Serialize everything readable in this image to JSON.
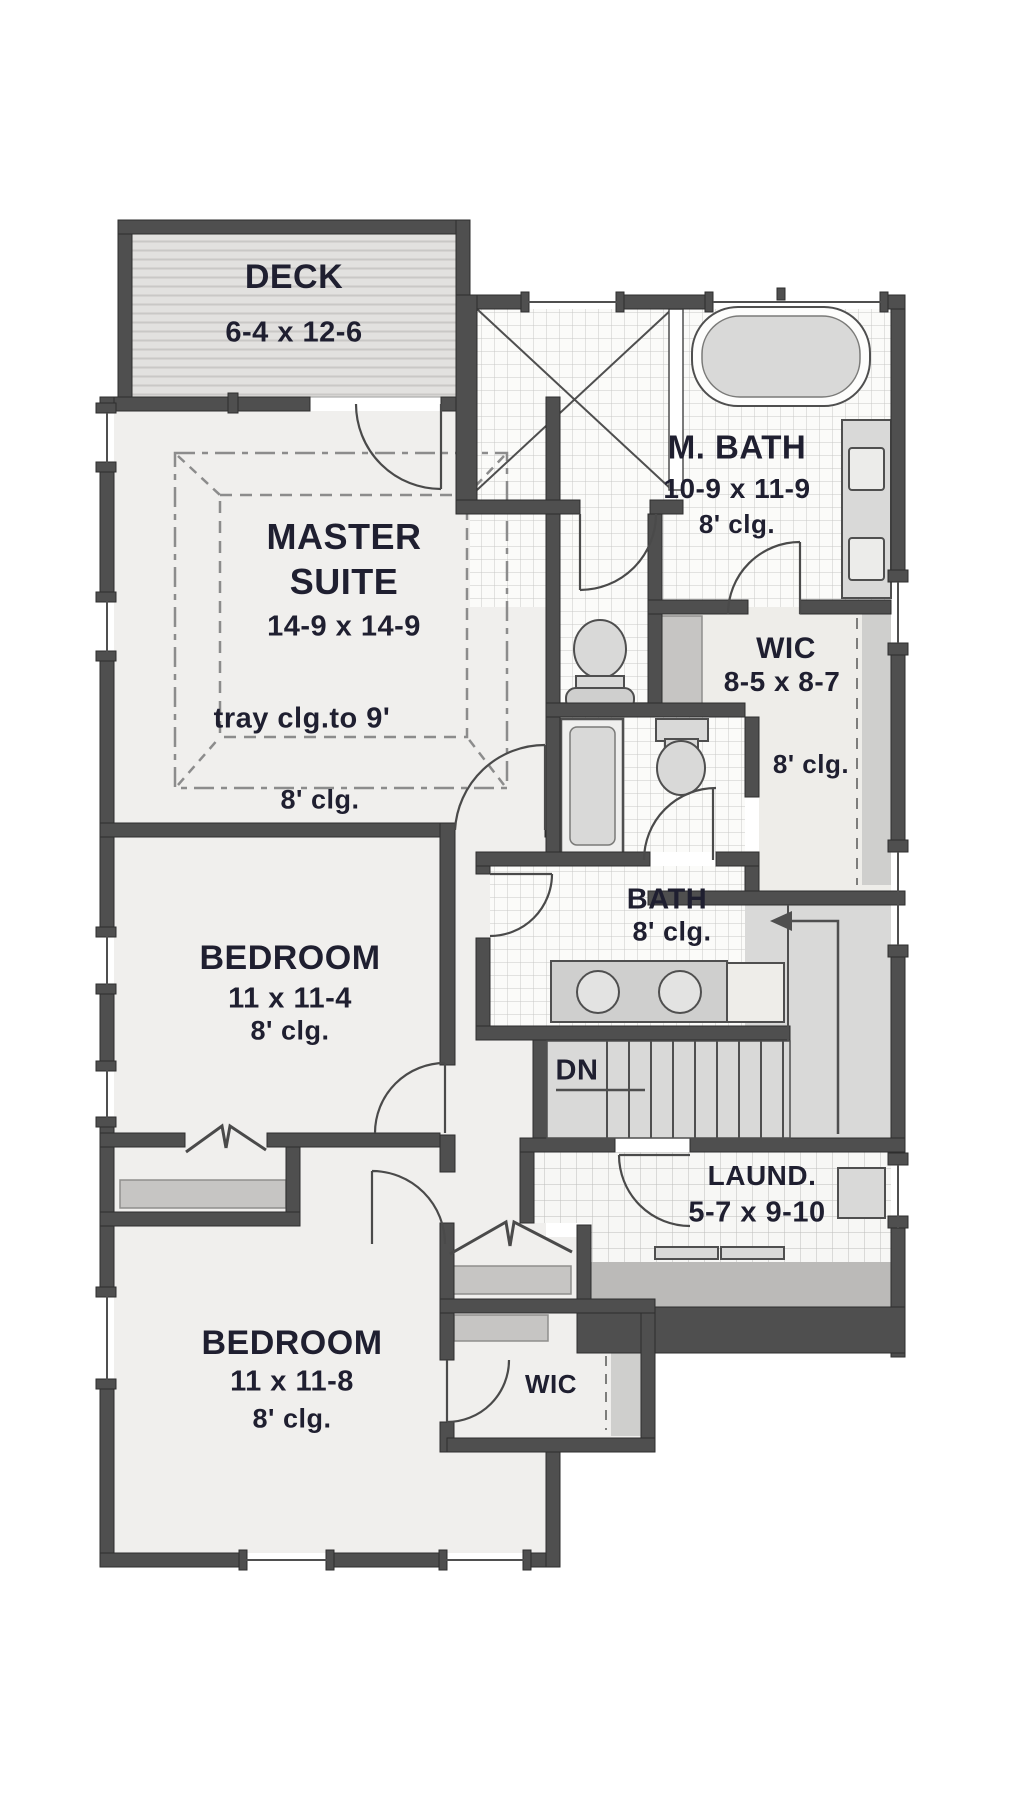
{
  "drawing_type": "floor-plan",
  "rooms": {
    "deck": {
      "name": "DECK",
      "dims": "6-4 x 12-6"
    },
    "master": {
      "name1": "MASTER",
      "name2": "SUITE",
      "dims": "14-9 x 14-9",
      "tray_note": "tray clg.to 9'",
      "clg": "8' clg."
    },
    "master_bath": {
      "name": "M. BATH",
      "dims": "10-9 x 11-9",
      "clg": "8' clg."
    },
    "wic": {
      "name": "WIC",
      "dims": "8-5 x 8-7",
      "clg": "8' clg."
    },
    "bath": {
      "name": "BATH",
      "clg": "8' clg."
    },
    "bedroom1": {
      "name": "BEDROOM",
      "dims": "11 x 11-4",
      "clg": "8' clg."
    },
    "bedroom2": {
      "name": "BEDROOM",
      "dims": "11 x 11-8",
      "clg": "8' clg."
    },
    "laundry": {
      "name": "LAUND.",
      "dims": "5-7 x 9-10"
    },
    "wic2": {
      "name": "WIC"
    },
    "stairs": {
      "direction": "DN"
    }
  },
  "colors": {
    "wall": "#4f4f4f",
    "floor_light": "#f0efed",
    "floor_gray": "#d9d9d8",
    "tile_bg": "#fbfbf9",
    "text": "#1f1f30"
  }
}
